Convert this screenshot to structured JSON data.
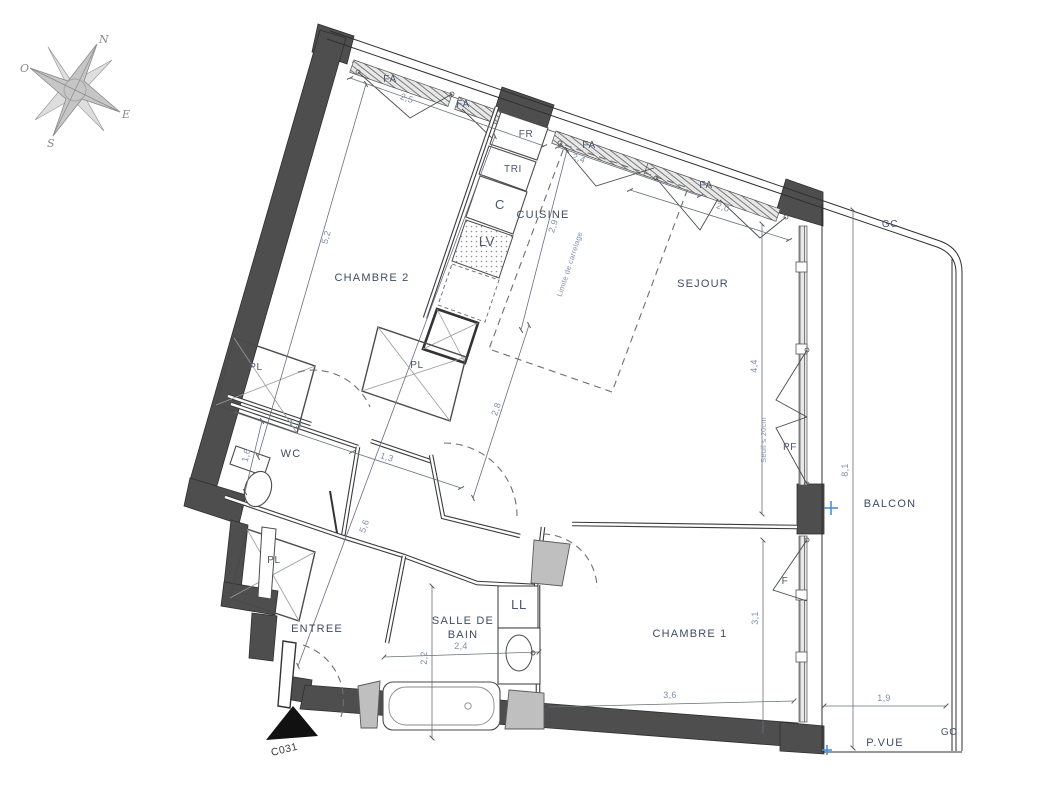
{
  "plan": {
    "code": "C031",
    "compass": {
      "north": "N",
      "west": "O",
      "east": "E",
      "south": "S"
    }
  },
  "rooms": {
    "chambre2": "CHAMBRE 2",
    "cuisine": "CUISINE",
    "sejour": "SEJOUR",
    "wc": "WC",
    "entree": "ENTREE",
    "sdb_line1": "SALLE DE",
    "sdb_line2": "BAIN",
    "chambre1": "CHAMBRE 1",
    "balcon": "BALCON",
    "pvue": "P.VUE"
  },
  "fixtures": {
    "fa": "FA",
    "fr": "FR",
    "tri": "TRI",
    "c": "C",
    "lv": "LV",
    "ll": "LL",
    "pl": "PL",
    "pf": "PF",
    "f": "F",
    "gc": "GC"
  },
  "dimensions": {
    "chambre2_window": "2,5",
    "cuisine_window": "2,4",
    "sejour_window": "2,0",
    "chambre2_length": "5,2",
    "cuisine_depth": "2,9",
    "hall_upper": "2,8",
    "hall_length": "5,6",
    "wc_width": "1,3",
    "hall_width": "1,3",
    "wc_depth": "1,6",
    "sejour_bay": "4,4",
    "chambre1_height": "3,1",
    "chambre1_width": "3,6",
    "sdb_width": "2,4",
    "sdb_depth": "2,2",
    "balcon_length": "8,1",
    "balcon_width": "1,9"
  },
  "annotations": {
    "carrelage": "Limite de carrelage",
    "seuil": "Seuil ≤ 20cm"
  },
  "colors": {
    "wall": "#4e4e4e",
    "dim_text": "#7e90a9",
    "label_text": "#3e4d62",
    "marker_blue": "#4a90d9"
  }
}
